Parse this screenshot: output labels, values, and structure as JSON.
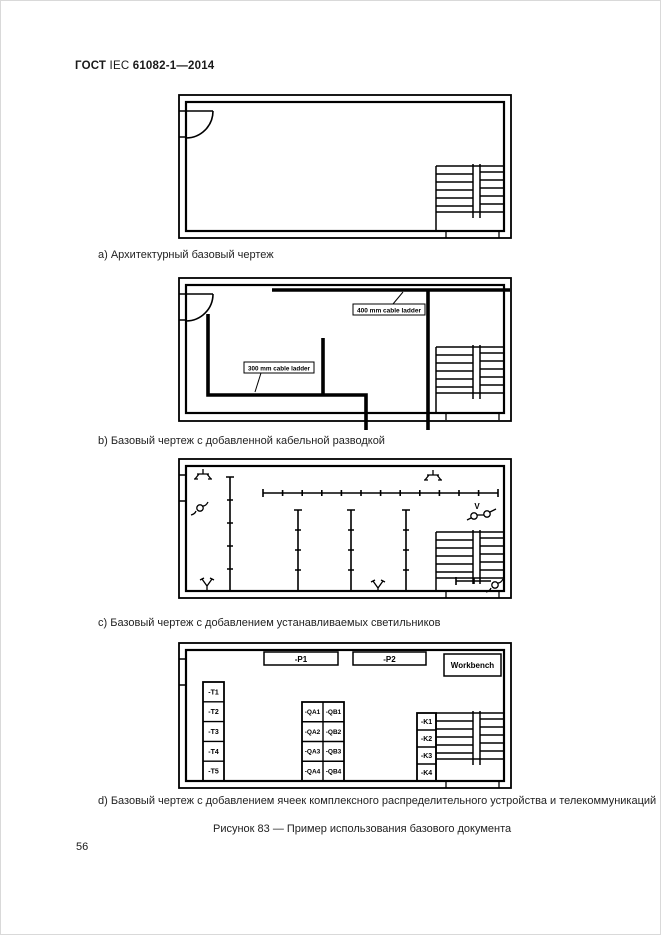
{
  "header": {
    "part1": "ГОСТ",
    "part2": " IEC ",
    "part3": "61082-1—2014"
  },
  "page_number": "56",
  "figure_caption": "Рисунок 83 — Пример использования базового документа",
  "captions": {
    "a": "a) Архитектурный базовый чертеж",
    "b": "b) Базовый чертеж с добавленной кабельной разводкой",
    "c": "c) Базовый чертеж с добавлением устанавливаемых светильников",
    "d": "d) Базовый чертеж с добавлением ячеек комплексного распределительного устройства и телекоммуникаций"
  },
  "drawing_b": {
    "cable_ladder_400": "400 mm cable ladder",
    "cable_ladder_300": "300 mm cable ladder"
  },
  "drawing_c": {
    "voltage_label": "V"
  },
  "drawing_d": {
    "panel_labels": [
      "-P1",
      "-P2"
    ],
    "workbench_label": "Workbench",
    "transformer_labels": [
      "-T1",
      "-T2",
      "-T3",
      "-T4",
      "-T5"
    ],
    "qa_labels": [
      "-QA1",
      "-QA2",
      "-QA3",
      "-QA4"
    ],
    "qb_labels": [
      "-QB1",
      "-QB2",
      "-QB3",
      "-QB4"
    ],
    "k_labels": [
      "-K1",
      "-K2",
      "-K3",
      "-K4"
    ]
  }
}
